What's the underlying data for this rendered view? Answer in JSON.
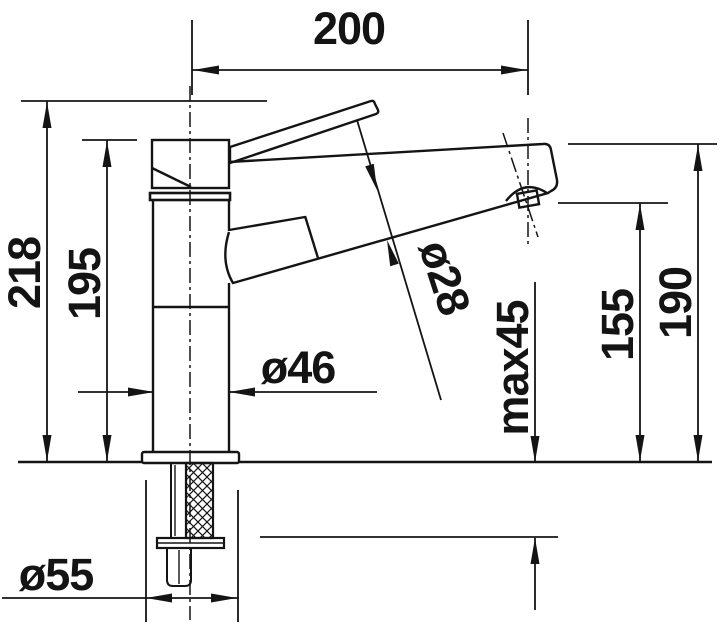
{
  "drawing": {
    "kind": "faucet-installation-dimension-drawing",
    "background_color": "#ffffff",
    "line_color": "#141414"
  },
  "labels": {
    "top_width": "200",
    "overall_height": "218",
    "body_height": "195",
    "outlet_height": "155",
    "spout_end_height": "190",
    "spout_diameter": "ø28",
    "body_diameter": "ø46",
    "base_diameter": "ø55",
    "max_deck_thickness": "max45"
  }
}
